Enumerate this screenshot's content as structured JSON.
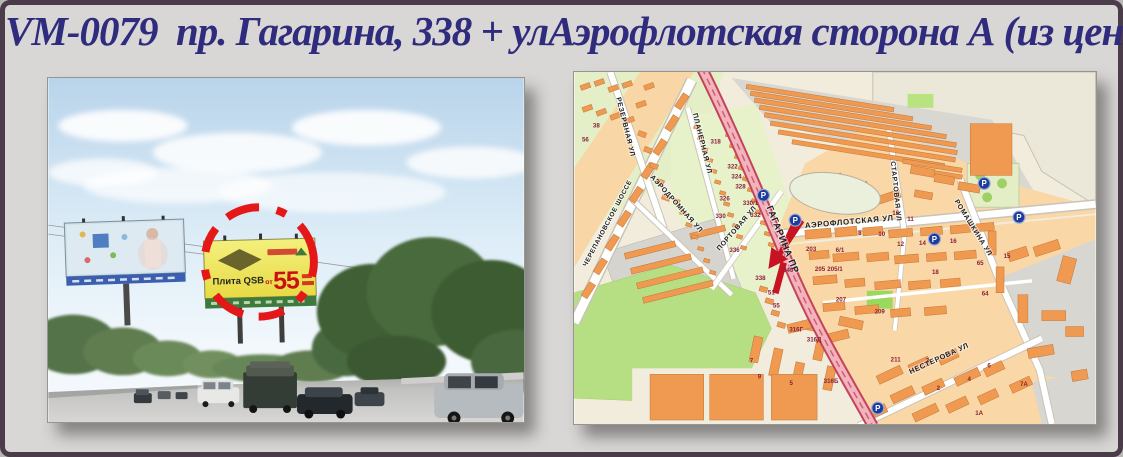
{
  "title": "VM-0079  пр. Гагарина, 338 + улАэрофлотская сторона А (из центра)",
  "colors": {
    "title_navy": "#2f2b7d",
    "highlight_red": "#e41818",
    "arrow_red": "#c81422",
    "parking_blue": "#1e3c9c",
    "number_red": "#8a2038",
    "gagarina_road_pink": "#f2b3bd",
    "building_orange": "#ef9a50"
  },
  "photo": {
    "circled_billboard": {
      "brand": "Плита QSB",
      "price_prefix": "от",
      "price": "55"
    }
  },
  "map": {
    "parking_label": "P",
    "parkings": [
      {
        "x": 190,
        "y": 124
      },
      {
        "x": 222,
        "y": 149
      },
      {
        "x": 412,
        "y": 112
      },
      {
        "x": 447,
        "y": 146
      },
      {
        "x": 362,
        "y": 168
      },
      {
        "x": 305,
        "y": 338
      }
    ],
    "streets": [
      {
        "id": "rezervnaya",
        "name": "РЕЗЕРВНАЯ УЛ",
        "x": 42,
        "y": 26,
        "rot": 76,
        "size": 7
      },
      {
        "id": "cherepanovskoe",
        "name": "ЧЕРЕПАНОВСКОЕ ШОССЕ",
        "x": 12,
        "y": 196,
        "rot": -62,
        "size": 6.5
      },
      {
        "id": "planernaya",
        "name": "ПЛАНЕРНАЯ УЛ",
        "x": 119,
        "y": 42,
        "rot": 76,
        "size": 7
      },
      {
        "id": "aerodromnaya",
        "name": "АЭРОДРОМНАЯ УЛ",
        "x": 76,
        "y": 106,
        "rot": 48,
        "size": 7
      },
      {
        "id": "portovaya",
        "name": "ПОРТОВАЯ УЛ",
        "x": 146,
        "y": 180,
        "rot": -49,
        "size": 7
      },
      {
        "id": "gagarina",
        "name": "ГАГАРИНА ПР",
        "x": 193,
        "y": 136,
        "rot": 68,
        "size": 9.5,
        "ls": 2.2
      },
      {
        "id": "aeroflotskaya",
        "name": "АЭРОФЛОТСКАЯ УЛ",
        "x": 232,
        "y": 157,
        "rot": -5,
        "size": 8
      },
      {
        "id": "startovaya",
        "name": "СТАРТОВАЯ УЛ",
        "x": 318,
        "y": 90,
        "rot": 84,
        "size": 7
      },
      {
        "id": "romashkina",
        "name": "РОМАШКИНА УЛ",
        "x": 382,
        "y": 130,
        "rot": 58,
        "size": 7
      },
      {
        "id": "nesterova",
        "name": "НЕСТЕРОВА УЛ",
        "x": 338,
        "y": 304,
        "rot": -25,
        "size": 7.5
      }
    ],
    "house_numbers": [
      {
        "t": "318",
        "x": 142,
        "y": 72
      },
      {
        "t": "322",
        "x": 159,
        "y": 97
      },
      {
        "t": "324",
        "x": 163,
        "y": 107
      },
      {
        "t": "328",
        "x": 167,
        "y": 117
      },
      {
        "t": "326",
        "x": 151,
        "y": 129
      },
      {
        "t": "330",
        "x": 147,
        "y": 147
      },
      {
        "t": "330/1",
        "x": 177,
        "y": 134
      },
      {
        "t": "332",
        "x": 182,
        "y": 146
      },
      {
        "t": "336",
        "x": 161,
        "y": 181
      },
      {
        "t": "338",
        "x": 187,
        "y": 209
      },
      {
        "t": "340",
        "x": 215,
        "y": 201
      },
      {
        "t": "51",
        "x": 198,
        "y": 224
      },
      {
        "t": "55",
        "x": 203,
        "y": 237
      },
      {
        "t": "203",
        "x": 238,
        "y": 180
      },
      {
        "t": "6/1",
        "x": 267,
        "y": 181
      },
      {
        "t": "205",
        "x": 247,
        "y": 200
      },
      {
        "t": "205/1",
        "x": 262,
        "y": 200
      },
      {
        "t": "207",
        "x": 268,
        "y": 231
      },
      {
        "t": "209",
        "x": 307,
        "y": 243
      },
      {
        "t": "8",
        "x": 287,
        "y": 164
      },
      {
        "t": "10",
        "x": 309,
        "y": 165
      },
      {
        "t": "12",
        "x": 328,
        "y": 175
      },
      {
        "t": "14",
        "x": 350,
        "y": 174
      },
      {
        "t": "16",
        "x": 381,
        "y": 172
      },
      {
        "t": "18",
        "x": 363,
        "y": 203
      },
      {
        "t": "11",
        "x": 338,
        "y": 150
      },
      {
        "t": "13",
        "x": 323,
        "y": 144
      },
      {
        "t": "15",
        "x": 435,
        "y": 187
      },
      {
        "t": "64",
        "x": 413,
        "y": 225
      },
      {
        "t": "65",
        "x": 408,
        "y": 194
      },
      {
        "t": "316Г",
        "x": 223,
        "y": 261
      },
      {
        "t": "316Д",
        "x": 241,
        "y": 271
      },
      {
        "t": "316Б",
        "x": 258,
        "y": 313
      },
      {
        "t": "5",
        "x": 218,
        "y": 315
      },
      {
        "t": "7",
        "x": 178,
        "y": 292
      },
      {
        "t": "9",
        "x": 186,
        "y": 308
      },
      {
        "t": "211",
        "x": 323,
        "y": 291
      },
      {
        "t": "3",
        "x": 355,
        "y": 292
      },
      {
        "t": "4",
        "x": 397,
        "y": 311
      },
      {
        "t": "6",
        "x": 417,
        "y": 297
      },
      {
        "t": "7А",
        "x": 452,
        "y": 316
      },
      {
        "t": "2",
        "x": 366,
        "y": 320
      },
      {
        "t": "1А",
        "x": 407,
        "y": 345
      },
      {
        "t": "38",
        "x": 22,
        "y": 56
      },
      {
        "t": "56",
        "x": 11,
        "y": 70
      }
    ]
  }
}
